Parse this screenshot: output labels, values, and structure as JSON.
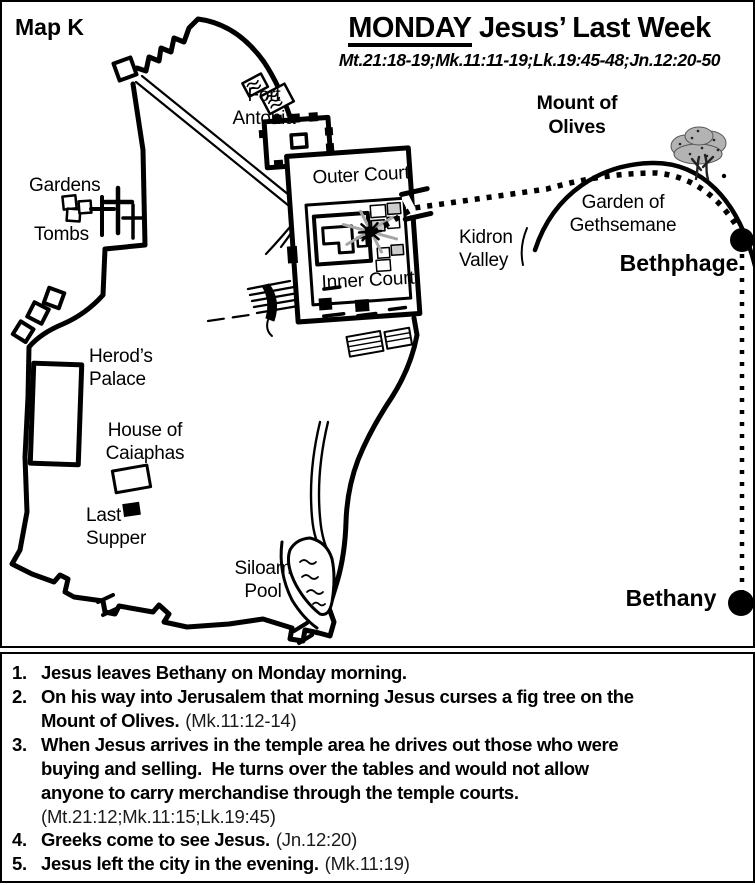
{
  "colors": {
    "ink": "#000000",
    "paper": "#ffffff",
    "ray_gray": "#a6a6a6",
    "tree_gray": "#b3b3b3"
  },
  "map": {
    "map_label": "Map K",
    "title": {
      "day": "MONDAY",
      "rest": " Jesus’ Last Week",
      "references": "Mt.21:18-19;Mk.11:11-19;Lk.19:45-48;Jn.12:20-50"
    },
    "labels": {
      "fort_antonia": "Fort\nAntonia",
      "outer_court": "Outer Court",
      "inner_court": "Inner Court",
      "gardens": "Gardens",
      "tombs": "Tombs",
      "herods_palace": "Herod’s\nPalace",
      "house_of_caiaphas": "House of\nCaiaphas",
      "last_supper": "Last\nSupper",
      "siloam_pool": "Siloam\nPool",
      "kidron_valley": "Kidron\nValley",
      "mount_of_olives": "Mount of\nOlives",
      "garden_of_gethsemane": "Garden of\nGethsemane",
      "bethphage": "Bethphage",
      "bethany": "Bethany"
    }
  },
  "events": {
    "items": [
      {
        "num": "1.",
        "text": "Jesus leaves Bethany on Monday morning.",
        "ref": ""
      },
      {
        "num": "2.",
        "text": "On his way into Jerusalem that morning Jesus curses a fig tree on the\nMount of Olives.",
        "ref": "(Mk.11:12-14)"
      },
      {
        "num": "3.",
        "text": "When Jesus arrives in the temple area he drives out those who were\nbuying and selling.  He turns over the tables and would not allow\nanyone to carry merchandise through the temple courts.",
        "ref": "(Mt.21:12;Mk.11:15;Lk.19:45)"
      },
      {
        "num": "4.",
        "text": "Greeks come to see Jesus.",
        "ref": "(Jn.12:20)"
      },
      {
        "num": "5.",
        "text": "Jesus left the city in the evening.",
        "ref": "(Mk.11:19)"
      }
    ]
  }
}
